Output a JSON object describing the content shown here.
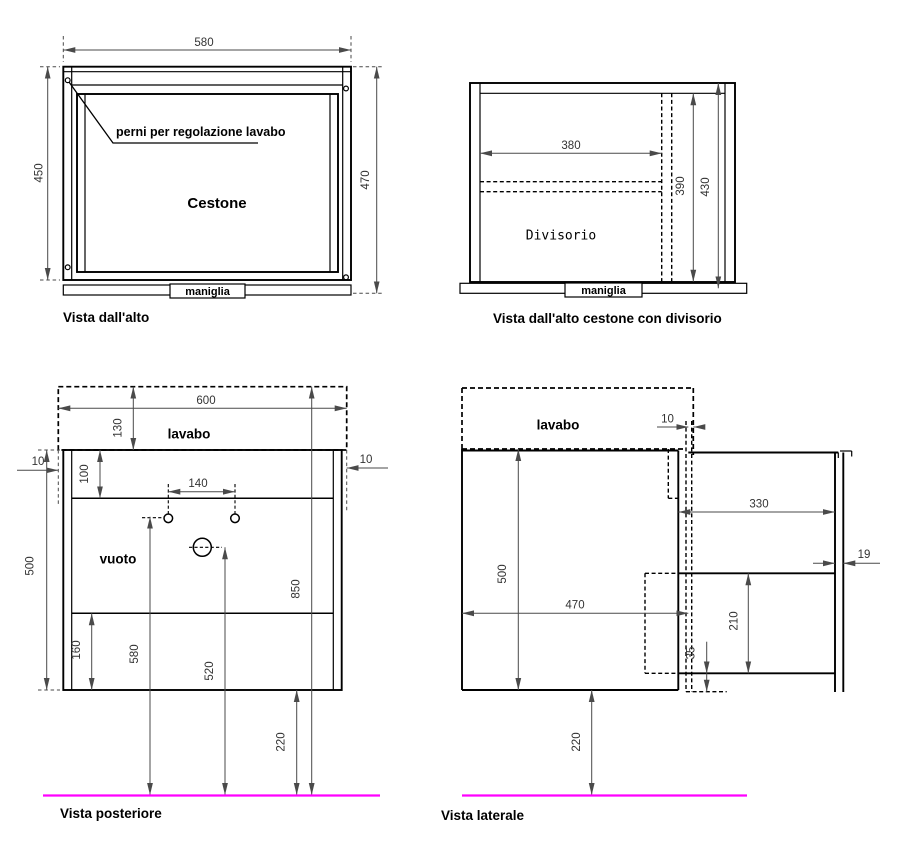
{
  "views": {
    "vista_dall_alto": {
      "caption": "Vista dall'alto",
      "cestone_label": "Cestone",
      "perni_label": "perni per regolazione lavabo",
      "maniglia_label": "maniglia",
      "dim_width": "580",
      "dim_depth_inner": "450",
      "dim_depth_outer": "470"
    },
    "vista_dall_alto_divisorio": {
      "caption": "Vista dall'alto cestone con divisorio",
      "divisorio_label": "Divisorio",
      "maniglia_label": "maniglia",
      "dim_divider_width": "380",
      "dim_depth_inner": "390",
      "dim_depth_outer": "430"
    },
    "vista_posteriore": {
      "caption": "Vista posteriore",
      "lavabo_label": "lavabo",
      "vuoto_label": "vuoto",
      "dim_width": "600",
      "dim_lavabo_height": "130",
      "dim_overhang_left": "10",
      "dim_overhang_right": "10",
      "dim_top_rail": "100",
      "dim_hole_spacing": "140",
      "dim_cabinet_height": "500",
      "dim_total_height": "850",
      "dim_bottom_panel": "160",
      "dim_holes_from_floor": "580",
      "dim_drain_from_floor": "520",
      "dim_floor_clearance": "220"
    },
    "vista_laterale": {
      "caption": "Vista laterale",
      "lavabo_label": "lavabo",
      "dim_overhang_front": "10",
      "dim_door_width": "330",
      "dim_panel_thickness": "19",
      "dim_cabinet_height": "500",
      "dim_depth": "470",
      "dim_drawer_front": "210",
      "dim_bottom_gap": "35",
      "dim_floor_clearance": "220"
    }
  },
  "colors": {
    "floor_line": "#ff00ff",
    "dimension": "#4a4a4a",
    "drawing": "#000000"
  }
}
